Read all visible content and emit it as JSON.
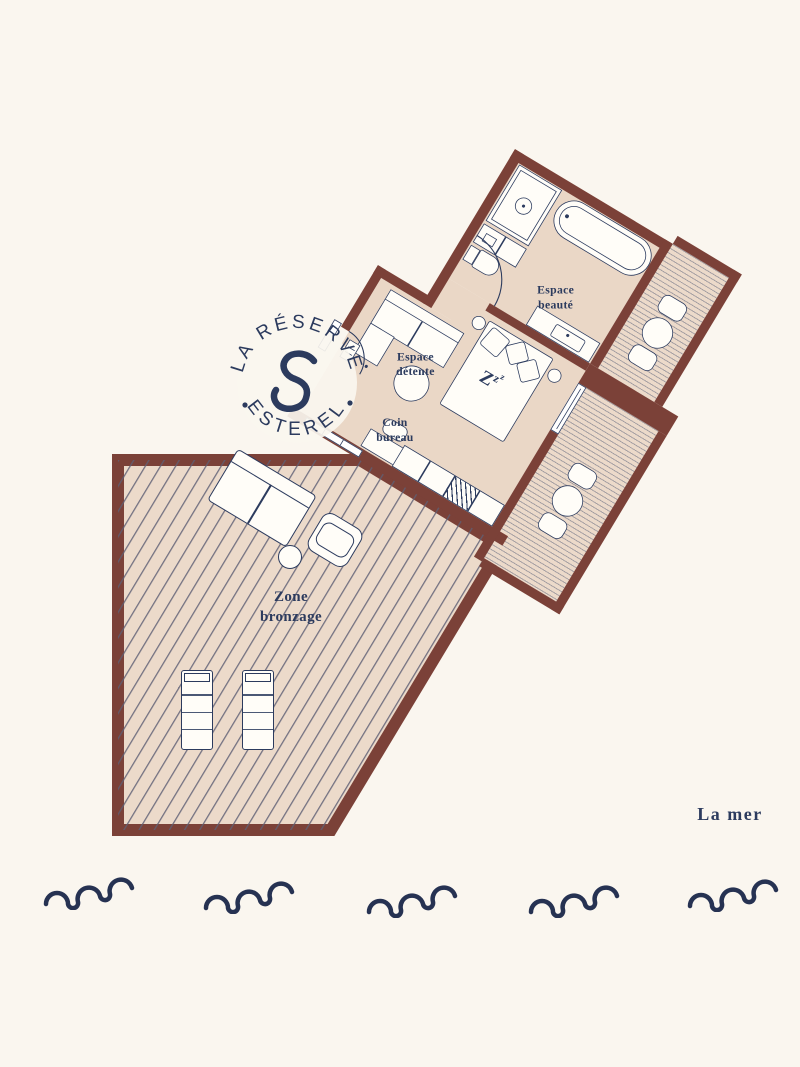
{
  "plan": {
    "logo": {
      "arc_top": "LA RÉSERVE",
      "arc_bottom": "ESTEREL",
      "monogram_name": "script-s"
    },
    "rooms": {
      "beauty": {
        "line1": "Espace",
        "line2": "beauté"
      },
      "lounge": {
        "line1": "Espace",
        "line2": "détente"
      },
      "office": {
        "line1": "Coin",
        "line2": "bureau"
      },
      "tanning": {
        "line1": "Zone",
        "line2": "bronzage"
      }
    },
    "bed": {
      "z1": "Z",
      "z2": "z",
      "z3": "z"
    },
    "sea_label": "La mer",
    "colors": {
      "background": "#FAF6EF",
      "wall": "#7B4138",
      "floor": "#EAD7C6",
      "deck": "#ECDACA",
      "ink": "#2C3B5E",
      "furniture": "#FFFDF8"
    }
  }
}
